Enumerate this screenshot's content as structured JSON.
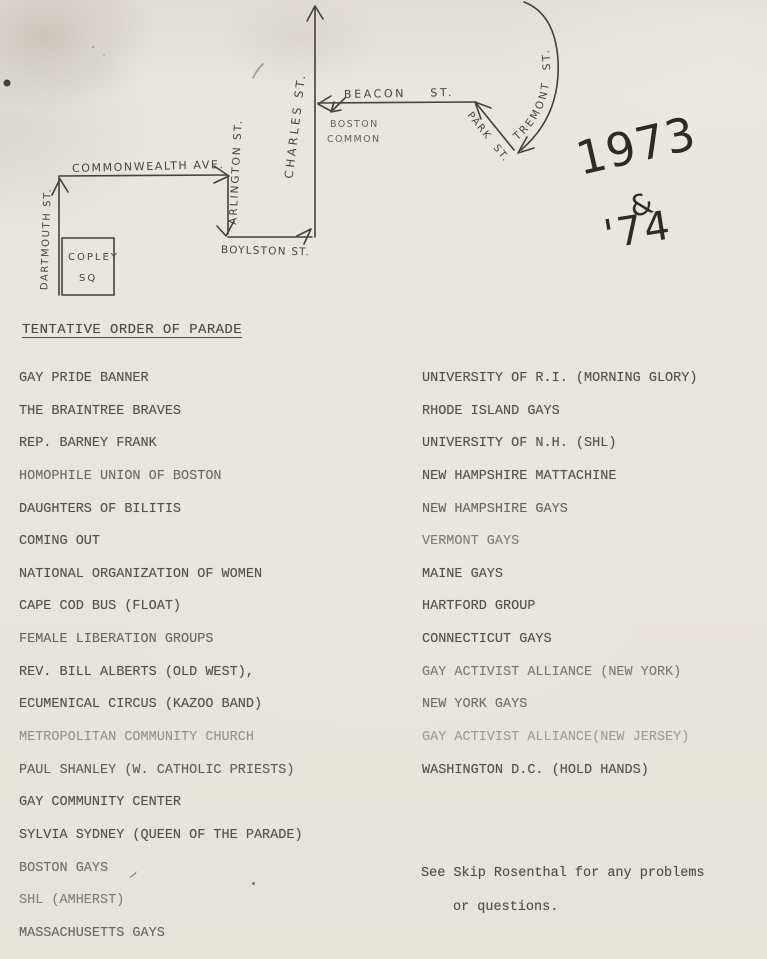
{
  "document": {
    "title": "TENTATIVE ORDER OF PARADE",
    "year_note": {
      "line1": "1973",
      "line2": "&",
      "line3": "'74"
    },
    "note_line1": "See Skip Rosenthal for any problems",
    "note_line2": "or questions."
  },
  "map": {
    "streets": {
      "commonwealth": "COMMONWEALTH AVE.",
      "dartmouth": "DARTMOUTH ST.",
      "arlington": "ARLINGTON ST.",
      "boylston": "BOYLSTON ST.",
      "charles": "CHARLES ST.",
      "beacon": "BEACON    ST.",
      "park": "PARK  ST.",
      "tremont": "TREMONT  ST."
    },
    "places": {
      "copley_line1": "COPLEY",
      "copley_line2": "SQ",
      "common_line1": "BOSTON",
      "common_line2": "COMMON"
    }
  },
  "parade": {
    "left": [
      "GAY PRIDE BANNER",
      "THE BRAINTREE BRAVES",
      "REP. BARNEY FRANK",
      "HOMOPHILE UNION OF BOSTON",
      "DAUGHTERS OF BILITIS",
      "COMING OUT",
      "NATIONAL ORGANIZATION OF WOMEN",
      "CAPE COD BUS (FLOAT)",
      "FEMALE LIBERATION GROUPS",
      "REV. BILL ALBERTS (OLD WEST),",
      "ECUMENICAL CIRCUS (KAZOO BAND)",
      "METROPOLITAN COMMUNITY CHURCH",
      "PAUL SHANLEY (W. CATHOLIC PRIESTS)",
      "GAY COMMUNITY CENTER",
      "SYLVIA SYDNEY (QUEEN OF THE PARADE)",
      "BOSTON GAYS",
      "SHL (AMHERST)",
      "MASSACHUSETTS GAYS"
    ],
    "right": [
      "UNIVERSITY OF R.I. (MORNING GLORY)",
      "RHODE ISLAND GAYS",
      "UNIVERSITY OF N.H. (SHL)",
      "NEW HAMPSHIRE MATTACHINE",
      "NEW HAMPSHIRE GAYS",
      "VERMONT GAYS",
      "MAINE GAYS",
      "HARTFORD GROUP",
      "CONNECTICUT GAYS",
      "GAY ACTIVIST ALLIANCE (NEW YORK)",
      "NEW YORK GAYS",
      "GAY ACTIVIST ALLIANCE(NEW JERSEY)",
      "WASHINGTON D.C. (HOLD HANDS)"
    ]
  },
  "colors": {
    "paper": "#e8e5de",
    "typewriter_ink": "#55524b",
    "pen_ink": "#2e2b27"
  }
}
